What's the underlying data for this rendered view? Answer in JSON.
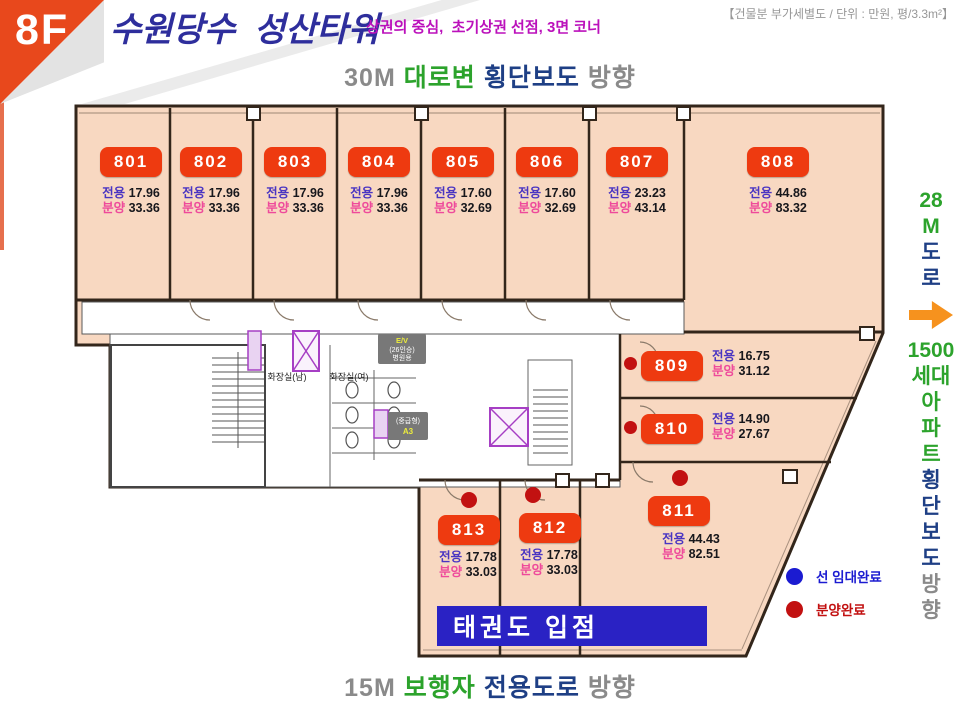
{
  "colors": {
    "peach": "#f8d8c1",
    "wall": "#33261b",
    "badge": "#ee3a10",
    "dot_red": "#c21111",
    "legend_blue": "#1b1bd1",
    "green": "#2ca32c",
    "navy": "#1e3f85",
    "gray": "#8a8a8a",
    "arrow": "#f6921e",
    "tenant": "#2a22c4",
    "title_navy": "#2e2e9c",
    "magenta": "#bb10bb",
    "label_exclusive": "#4a35c2",
    "label_sale": "#ee4a9b",
    "value": "#17171c",
    "shaft_purple": "#a63fc4",
    "ev_gray": "#787878",
    "ev_yellow": "#eded3c"
  },
  "header": {
    "floor": "8F",
    "title": "수원당수  성산타워",
    "subtitle": "상권의 중심,  초기상권 선점, 3면 코너",
    "note": "【건물분 부가세별도 / 단위 : 만원, 평/3.3m²】"
  },
  "directions": {
    "top": {
      "parts": [
        {
          "t": "30M",
          "c": "gray"
        },
        {
          "t": "대로변",
          "c": "green"
        },
        {
          "t": "횡단보도",
          "c": "navy"
        },
        {
          "t": "방향",
          "c": "gray"
        }
      ]
    },
    "bottom": {
      "parts": [
        {
          "t": "15M",
          "c": "gray"
        },
        {
          "t": "보행자",
          "c": "green"
        },
        {
          "t": "전용도로",
          "c": "navy"
        },
        {
          "t": "방향",
          "c": "gray"
        }
      ]
    },
    "right": {
      "items": [
        {
          "t": "28",
          "c": "green"
        },
        {
          "t": "M",
          "c": "green"
        },
        {
          "t": "도",
          "c": "navy"
        },
        {
          "t": "로",
          "c": "navy"
        },
        {
          "t": "",
          "c": "arrow"
        },
        {
          "t": "1500",
          "c": "green"
        },
        {
          "t": "세대",
          "c": "green"
        },
        {
          "t": "아",
          "c": "green"
        },
        {
          "t": "파",
          "c": "green"
        },
        {
          "t": "트",
          "c": "green"
        },
        {
          "t": "횡",
          "c": "navy"
        },
        {
          "t": "단",
          "c": "navy"
        },
        {
          "t": "보",
          "c": "navy"
        },
        {
          "t": "도",
          "c": "navy"
        },
        {
          "t": "방",
          "c": "gray"
        },
        {
          "t": "향",
          "c": "gray"
        }
      ]
    }
  },
  "area_labels": {
    "exclusive": "전용",
    "sale": "분양"
  },
  "units": [
    {
      "no": "801",
      "exclusive": "17.96",
      "sale": "33.36",
      "status": ""
    },
    {
      "no": "802",
      "exclusive": "17.96",
      "sale": "33.36",
      "status": ""
    },
    {
      "no": "803",
      "exclusive": "17.96",
      "sale": "33.36",
      "status": ""
    },
    {
      "no": "804",
      "exclusive": "17.96",
      "sale": "33.36",
      "status": ""
    },
    {
      "no": "805",
      "exclusive": "17.60",
      "sale": "32.69",
      "status": ""
    },
    {
      "no": "806",
      "exclusive": "17.60",
      "sale": "32.69",
      "status": ""
    },
    {
      "no": "807",
      "exclusive": "23.23",
      "sale": "43.14",
      "status": ""
    },
    {
      "no": "808",
      "exclusive": "44.86",
      "sale": "83.32",
      "status": ""
    },
    {
      "no": "809",
      "exclusive": "16.75",
      "sale": "31.12",
      "status": "sold"
    },
    {
      "no": "810",
      "exclusive": "14.90",
      "sale": "27.67",
      "status": "sold"
    },
    {
      "no": "811",
      "exclusive": "44.43",
      "sale": "82.51",
      "status": "sold"
    },
    {
      "no": "812",
      "exclusive": "17.78",
      "sale": "33.03",
      "status": "sold"
    },
    {
      "no": "813",
      "exclusive": "17.78",
      "sale": "33.03",
      "status": "sold"
    }
  ],
  "legend": [
    {
      "label": "선 임대완료",
      "color_key": "legend_blue"
    },
    {
      "label": "분양완료",
      "color_key": "dot_red"
    }
  ],
  "core": {
    "restroom_men": "화장실(남)",
    "restroom_women": "화장실(여)",
    "ev1": [
      "E/V",
      "(26인승)",
      "병원용"
    ],
    "ev2": [
      "(중급형)",
      "A3"
    ]
  },
  "overlay": {
    "tenant": "태권도 입점"
  }
}
